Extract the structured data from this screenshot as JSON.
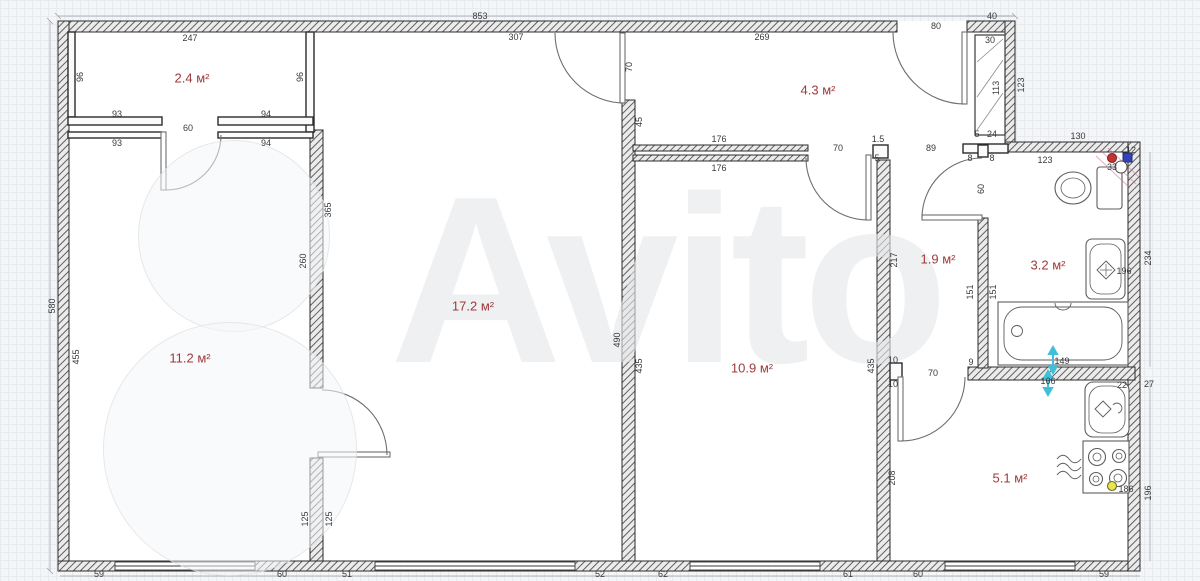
{
  "watermark": {
    "text": "Avito"
  },
  "room_labels": [
    {
      "t": "2.4 м²",
      "x": 192,
      "y": 78
    },
    {
      "t": "4.3 м²",
      "x": 818,
      "y": 90
    },
    {
      "t": "17.2 м²",
      "x": 473,
      "y": 306
    },
    {
      "t": "11.2 м²",
      "x": 190,
      "y": 358
    },
    {
      "t": "10.9 м²",
      "x": 752,
      "y": 368
    },
    {
      "t": "1.9 м²",
      "x": 938,
      "y": 259
    },
    {
      "t": "3.2 м²",
      "x": 1048,
      "y": 265
    },
    {
      "t": "5.1 м²",
      "x": 1010,
      "y": 478
    }
  ],
  "dimensions": [
    {
      "t": "853",
      "x": 480,
      "y": 16
    },
    {
      "t": "40",
      "x": 992,
      "y": 16
    },
    {
      "t": "247",
      "x": 190,
      "y": 38
    },
    {
      "t": "307",
      "x": 516,
      "y": 37
    },
    {
      "t": "269",
      "x": 762,
      "y": 37
    },
    {
      "t": "80",
      "x": 936,
      "y": 26
    },
    {
      "t": "30",
      "x": 990,
      "y": 40
    },
    {
      "t": "96",
      "x": 80,
      "y": 77,
      "v": true
    },
    {
      "t": "96",
      "x": 300,
      "y": 77,
      "v": true
    },
    {
      "t": "70",
      "x": 629,
      "y": 67,
      "v": true
    },
    {
      "t": "123",
      "x": 1021,
      "y": 85,
      "v": true
    },
    {
      "t": "113",
      "x": 996,
      "y": 88,
      "v": true
    },
    {
      "t": "93",
      "x": 117,
      "y": 114
    },
    {
      "t": "94",
      "x": 266,
      "y": 114
    },
    {
      "t": "60",
      "x": 188,
      "y": 128
    },
    {
      "t": "93",
      "x": 117,
      "y": 143
    },
    {
      "t": "94",
      "x": 266,
      "y": 143
    },
    {
      "t": "45",
      "x": 639,
      "y": 122,
      "v": true
    },
    {
      "t": "5",
      "x": 977,
      "y": 134
    },
    {
      "t": "24",
      "x": 992,
      "y": 134
    },
    {
      "t": "130",
      "x": 1078,
      "y": 136
    },
    {
      "t": "176",
      "x": 719,
      "y": 139
    },
    {
      "t": "1.5",
      "x": 878,
      "y": 139
    },
    {
      "t": "70",
      "x": 838,
      "y": 148
    },
    {
      "t": "89",
      "x": 931,
      "y": 148
    },
    {
      "t": "5",
      "x": 877,
      "y": 158
    },
    {
      "t": "8",
      "x": 970,
      "y": 158
    },
    {
      "t": "8",
      "x": 992,
      "y": 158
    },
    {
      "t": "123",
      "x": 1045,
      "y": 160
    },
    {
      "t": "12",
      "x": 1131,
      "y": 150
    },
    {
      "t": "33",
      "x": 1112,
      "y": 167
    },
    {
      "t": "176",
      "x": 719,
      "y": 168
    },
    {
      "t": "60",
      "x": 981,
      "y": 189,
      "v": true
    },
    {
      "t": "365",
      "x": 328,
      "y": 210,
      "v": true
    },
    {
      "t": "217",
      "x": 894,
      "y": 260,
      "v": true
    },
    {
      "t": "260",
      "x": 303,
      "y": 261,
      "v": true
    },
    {
      "t": "234",
      "x": 1148,
      "y": 258,
      "v": true
    },
    {
      "t": "196",
      "x": 1124,
      "y": 271
    },
    {
      "t": "151",
      "x": 970,
      "y": 292,
      "v": true
    },
    {
      "t": "151",
      "x": 993,
      "y": 292,
      "v": true
    },
    {
      "t": "580",
      "x": 52,
      "y": 306,
      "v": true
    },
    {
      "t": "490",
      "x": 617,
      "y": 340,
      "v": true
    },
    {
      "t": "455",
      "x": 76,
      "y": 357,
      "v": true
    },
    {
      "t": "435",
      "x": 639,
      "y": 366,
      "v": true
    },
    {
      "t": "435",
      "x": 871,
      "y": 366,
      "v": true
    },
    {
      "t": "10",
      "x": 893,
      "y": 360
    },
    {
      "t": "9",
      "x": 971,
      "y": 362
    },
    {
      "t": "149",
      "x": 1062,
      "y": 361
    },
    {
      "t": "70",
      "x": 933,
      "y": 373
    },
    {
      "t": "10",
      "x": 893,
      "y": 384
    },
    {
      "t": "166",
      "x": 1048,
      "y": 381
    },
    {
      "t": "22",
      "x": 1122,
      "y": 385
    },
    {
      "t": "27",
      "x": 1149,
      "y": 384
    },
    {
      "t": "208",
      "x": 892,
      "y": 478,
      "v": true
    },
    {
      "t": "186",
      "x": 1126,
      "y": 489
    },
    {
      "t": "196",
      "x": 1148,
      "y": 493,
      "v": true
    },
    {
      "t": "125",
      "x": 305,
      "y": 519,
      "v": true
    },
    {
      "t": "125",
      "x": 329,
      "y": 519,
      "v": true
    },
    {
      "t": "59",
      "x": 99,
      "y": 574
    },
    {
      "t": "60",
      "x": 282,
      "y": 574
    },
    {
      "t": "51",
      "x": 347,
      "y": 574
    },
    {
      "t": "52",
      "x": 600,
      "y": 574
    },
    {
      "t": "62",
      "x": 663,
      "y": 574
    },
    {
      "t": "61",
      "x": 848,
      "y": 574
    },
    {
      "t": "60",
      "x": 918,
      "y": 574
    },
    {
      "t": "59",
      "x": 1104,
      "y": 574
    }
  ],
  "colors": {
    "room_label": "#9d3a3a",
    "dim_text": "#3a3a3a",
    "wall": "#2b2b2b",
    "cyan_marker": "#3fc0d8",
    "yellow_marker": "#e9e64d",
    "hot_riser": "#c23333",
    "cold_riser": "#3344bb"
  }
}
